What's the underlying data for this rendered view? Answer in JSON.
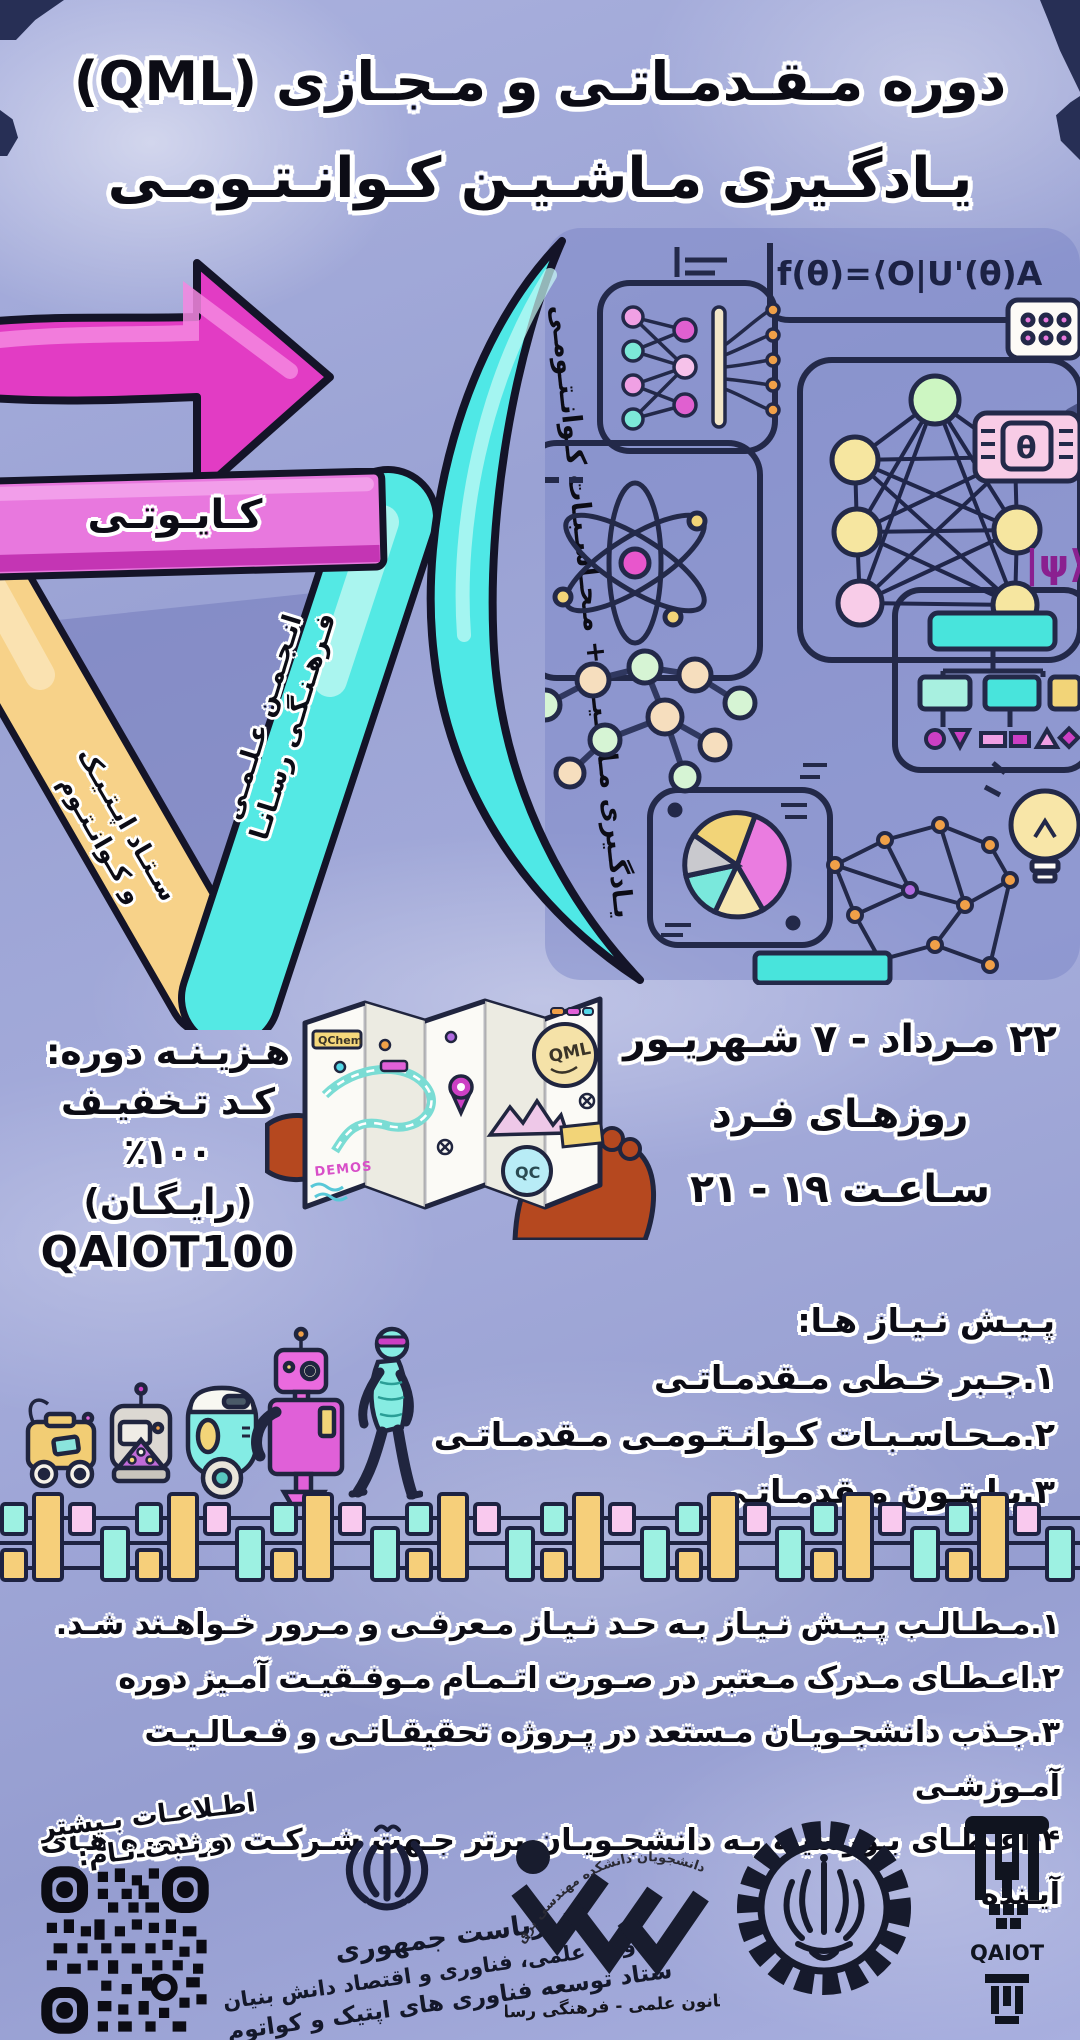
{
  "poster": {
    "title_line1": "دوره مـقـدمـاتـی و مـجـازی (QML)",
    "title_line2": "یـادگـیری مـاشـیـن کـوانـتـومـی",
    "equation": "f(θ)=⟨O|U'(θ)A",
    "psi": "|ψ⟩",
    "theta": "θ",
    "band_qaiot": "کـایـوتـی",
    "band_rasana_l1": "انـجـمـن عـلـمـی",
    "band_rasana_l2": "فـرهـنـگـی رسـانـا",
    "band_setad_l1": "سـتـاد اپـتـیـک",
    "band_setad_l2": "و کـوانـتـوم",
    "arc_text": "یـادگـیری مـاشـیـن + مـحـاسـبـات کـوانـتـومـی"
  },
  "schedule": {
    "dates": "۲۲ مـرداد - ۷ شـهریـور",
    "days": "روزهـای فـرد",
    "time": "سـاعـت ۱۹ - ۲۱"
  },
  "cost": {
    "heading": "هـزیـنـه دوره:",
    "discount": "کـد تـخفیـف ۱۰۰٪",
    "free": "(رایـگـان)",
    "code": "QAIOT100"
  },
  "map_labels": {
    "qml": "QML",
    "qc": "QC",
    "qchem": "QChem",
    "demos": "DEMOS"
  },
  "prerequisites": {
    "heading": "پـیـش نـیـاز هـا:",
    "item1": "۱.جـبر خـطی مـقدمـاتـی",
    "item2": "۲.مـحـاسـبـات کـوانـتـومـی مـقدمـاتـی",
    "item3": "۳.پـایتـون مـقدمـاتـی"
  },
  "notes": {
    "item1": "۱.مـطـالـب پـیـش نـیـاز بـه حـد نـیـاز مـعرفـی و مـرور خـواهـند شـد.",
    "item2": "۲.اعـطـای مـدرک مـعتبر در صـورت اتـمـام مـوفـقیـت آمـیز دوره",
    "item3": "۳.جـذب دانشجـویـان مـستعد در پـروژه تحقیقـاتـی و فـعـالـیـت آمـوزشـی",
    "item4": "۴.اعـطـای بـورسیـه بـه دانشجـویـان برتر جـهت شـرکـت در دوره هـای آیـنده"
  },
  "footer": {
    "register_l1": "اطـلاعـات بـیشتر",
    "register_l2": "و ثـبت نـام:",
    "gov_line1": "ریاست جمهوری",
    "gov_line2": "معاونت علمی، فناوری و اقتصاد دانش بنیان",
    "gov_line3": "ستاد توسعه فناوری های اپتیک و کواتوم",
    "rasana_arc": "دانشجویان دانشکده مهندسی برق",
    "rasana_caption": "کانون علمی - فرهنگی رسانا",
    "sharif_name": "دانشگاه صنعتی شریف",
    "qaiot_label": "QAIOT"
  },
  "colors": {
    "background": "#9ea6d8",
    "magenta_arrow": "#e23cc4",
    "pink_band": "#e878de",
    "teal": "#54e9e4",
    "yellow": "#f7d289",
    "ink_outline": "#141428"
  }
}
